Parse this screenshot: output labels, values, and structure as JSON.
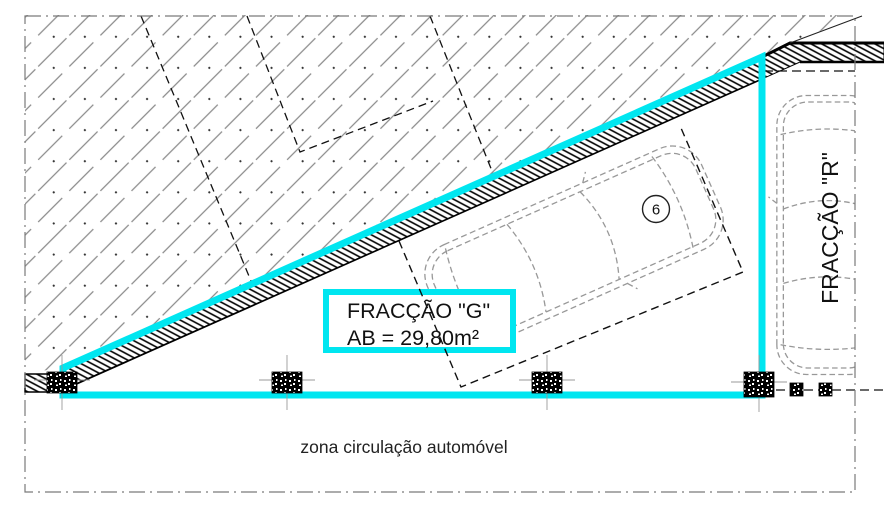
{
  "drawing": {
    "fraction_g_label": {
      "line1": "FRACÇÃO \"G\"",
      "line2": "AB = 29,80m²"
    },
    "fraction_r_label": "FRACÇÃO \"R\"",
    "zone_label": "zona circulação automóvel",
    "parking_space_number": "6"
  },
  "colors": {
    "highlight_cyan": "#00e6f0",
    "hatch_gray": "#8a8a8a",
    "draw_black": "#111111",
    "car_gray": "#989898",
    "border_gray": "#7a7a7a",
    "background": "#ffffff"
  }
}
